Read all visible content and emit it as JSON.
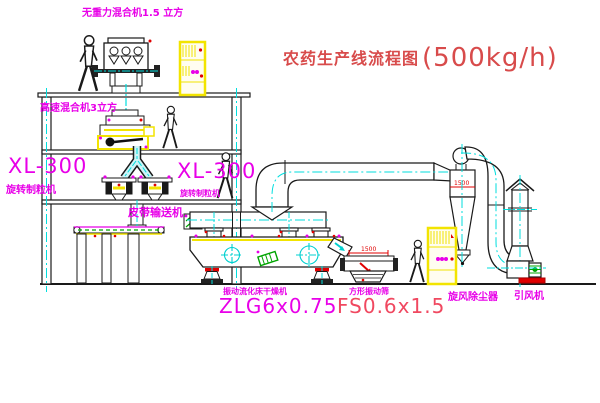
{
  "title": {
    "text_zh": "农药生产线流程图",
    "capacity": "(500kg/h)"
  },
  "labels": {
    "gravity_mixer": "无重力混合机1.5 立方",
    "high_speed_mixer": "高速混合机3立方",
    "granulator_left_model": "XL-300",
    "granulator_left_name": "旋转制粒机",
    "granulator_center_model": "XL-300",
    "granulator_center_name": "旋转制粒机",
    "belt_conveyor": "皮带输送机",
    "fluid_bed_dryer_name": "振动流化床干燥机",
    "fluid_bed_dryer_model": "ZLG6x0.75",
    "vibrating_sieve_name": "方形振动筛",
    "vibrating_sieve_model": "FS0.6x1.5",
    "cyclone_dust_collector": "旋风除尘器",
    "induced_draft_fan": "引风机"
  },
  "dimensions": {
    "sieve_width": "1500",
    "cyclone_diameter": "1500"
  },
  "colors": {
    "label_magenta": "#e800e8",
    "title_red": "#d84b4b",
    "model_red": "#f04860",
    "line_black": "#1a1a1a",
    "centerline_cyan": "#00dede",
    "machine_yellow": "#f2e400",
    "detail_green": "#00a400",
    "detail_red": "#e00000"
  }
}
